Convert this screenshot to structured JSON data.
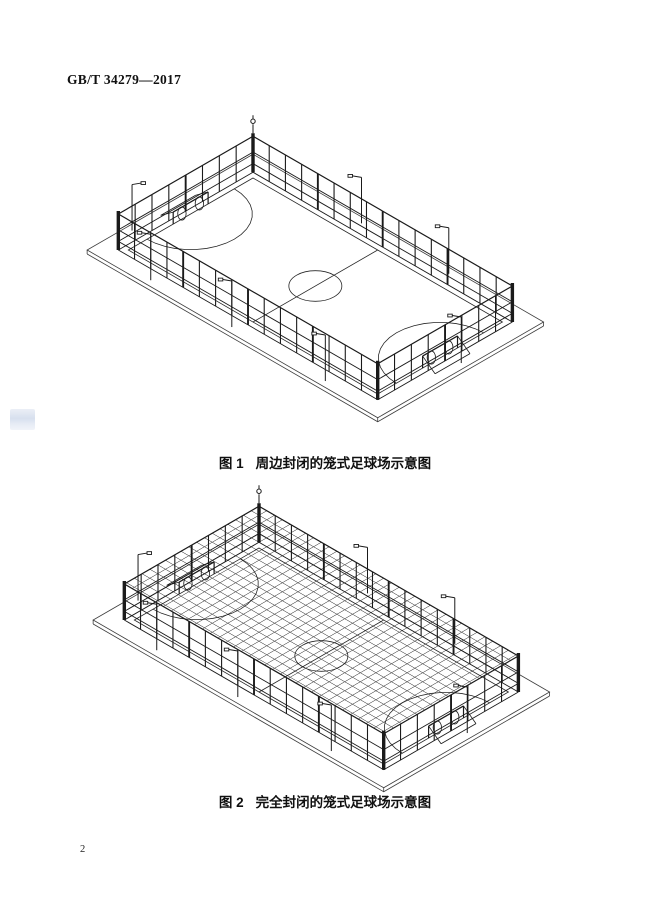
{
  "colors": {
    "ink": "#1a1a1a",
    "paper": "#ffffff",
    "watermark": "#cdd8ea"
  },
  "header": {
    "standard_number": "GB/T 34279—2017"
  },
  "figures": [
    {
      "caption_label": "图 1",
      "caption_text": "周边封闭的笼式足球场示意图",
      "mesh": false
    },
    {
      "caption_label": "图 2",
      "caption_text": "完全封闭的笼式足球场示意图",
      "mesh": true
    }
  ],
  "footer": {
    "page_number": "2"
  }
}
